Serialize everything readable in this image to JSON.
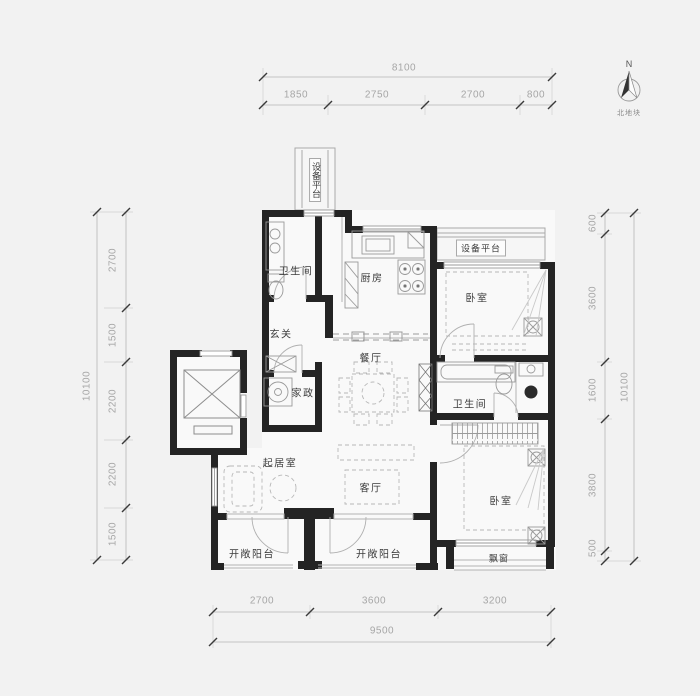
{
  "meta": {
    "page_bg": "#f2f2f2",
    "wall_color": "#242424",
    "dim_text_color": "#a6a6a6",
    "label_text_color": "#3b3b3b"
  },
  "north": {
    "letter": "N",
    "caption": "北地块"
  },
  "dims": {
    "top_overall": "8100",
    "top_segments": [
      "1850",
      "2750",
      "2700",
      "800"
    ],
    "bottom_overall": "9500",
    "bottom_segments": [
      "2700",
      "3600",
      "3200"
    ],
    "left_overall": "10100",
    "left_segments": [
      "2700",
      "1500",
      "2200",
      "2200",
      "1500"
    ],
    "right_overall": "10100",
    "right_segments": [
      "600",
      "3600",
      "1600",
      "3800",
      "500"
    ]
  },
  "rooms": {
    "equipment_platform_top": "设备平台",
    "bathroom_1": "卫生间",
    "kitchen": "厨房",
    "equipment_platform_right": "设备平台",
    "bedroom_1": "卧室",
    "entry": "玄关",
    "dining": "餐厅",
    "housekeeping": "家政",
    "bathroom_2": "卫生间",
    "sitting_room": "起居室",
    "living_room": "客厅",
    "bedroom_2": "卧室",
    "bay_window": "飘窗",
    "balcony_left": "开敞阳台",
    "balcony_right": "开敞阳台"
  }
}
